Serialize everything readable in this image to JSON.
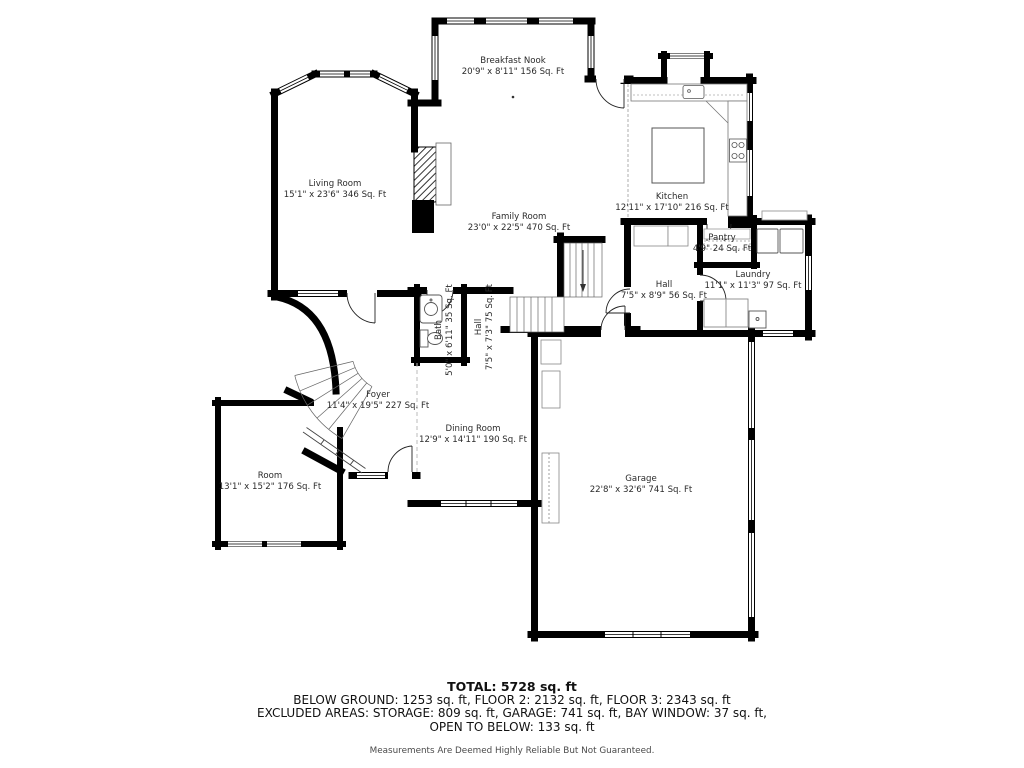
{
  "plan": {
    "rooms": {
      "breakfast_nook": {
        "name": "Breakfast Nook",
        "dims": "20'9\" x 8'11\" 156 Sq. Ft"
      },
      "living_room": {
        "name": "Living Room",
        "dims": "15'1\" x 23'6\" 346 Sq. Ft"
      },
      "family_room": {
        "name": "Family Room",
        "dims": "23'0\" x 22'5\" 470 Sq. Ft"
      },
      "kitchen": {
        "name": "Kitchen",
        "dims": "12'11\" x 17'10\" 216 Sq. Ft"
      },
      "pantry": {
        "name": "Pantry",
        "dims": "4'9\" 24 Sq. Ft"
      },
      "laundry": {
        "name": "Laundry",
        "dims": "11'1\" x 11'3\" 97 Sq. Ft"
      },
      "hall_main": {
        "name": "Hall",
        "dims": "7'5\" x 8'9\" 56 Sq. Ft"
      },
      "bath": {
        "name": "Bath",
        "dims": "5'0\" x 6'11\" 35 Sq. Ft"
      },
      "hall_small": {
        "name": "Hall",
        "dims": "7'5\" x 7'3\" 75 Sq. Ft"
      },
      "foyer": {
        "name": "Foyer",
        "dims": "11'4\" x 19'5\" 227 Sq. Ft"
      },
      "dining_room": {
        "name": "Dining Room",
        "dims": "12'9\" x 14'11\" 190 Sq. Ft"
      },
      "room": {
        "name": "Room",
        "dims": "13'1\" x 15'2\" 176 Sq. Ft"
      },
      "garage": {
        "name": "Garage",
        "dims": "22'8\" x 32'6\" 741 Sq. Ft"
      }
    },
    "colors": {
      "wall": "#000000",
      "fixture": "#555555",
      "text": "#2b2b2b"
    }
  },
  "summary": {
    "total": "TOTAL: 5728 sq. ft",
    "line1": "BELOW GROUND: 1253 sq. ft, FLOOR 2: 2132 sq. ft, FLOOR 3: 2343 sq. ft",
    "line2": "EXCLUDED AREAS: STORAGE: 809 sq. ft, GARAGE: 741 sq. ft, BAY WINDOW: 37 sq. ft,",
    "line3": "OPEN TO BELOW: 133 sq. ft",
    "disclaimer": "Measurements Are Deemed Highly Reliable But Not Guaranteed."
  }
}
